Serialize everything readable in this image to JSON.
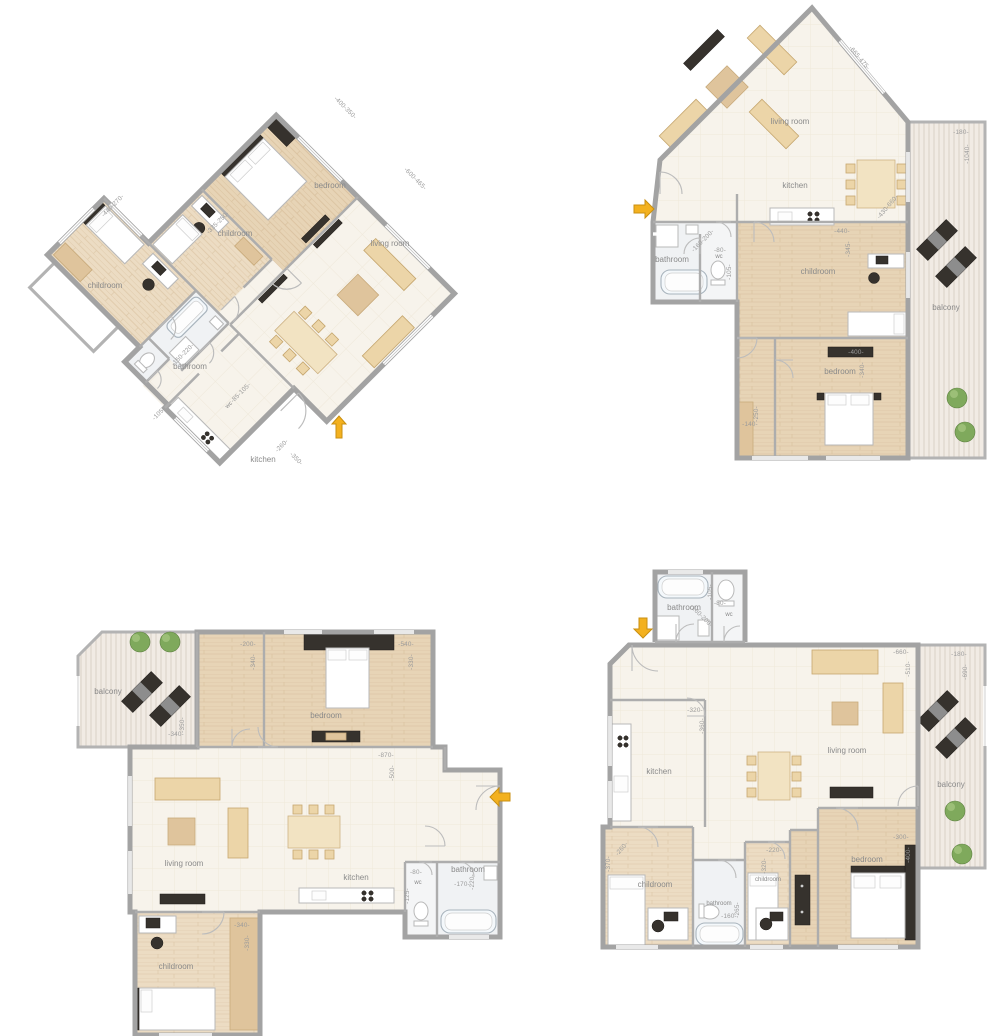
{
  "page": {
    "title": "apartment floor plans",
    "background": "#ffffff"
  },
  "colors": {
    "wall": "#a6a6a6",
    "floor_tile": "#f7f3eb",
    "floor_wood": "#e7d4b6",
    "floor_wood_light": "#ecdcc3",
    "balcony_deck": "#f1ebe4",
    "entry_arrow": "#f3b11f",
    "furniture_tan": "#ecd5a8",
    "furniture_dark": "#36322d",
    "label_text": "#8a8a8a",
    "dim_text": "#9b9b9b"
  },
  "plans": [
    {
      "id": "plan-top-left",
      "orientation": "rotated 45deg",
      "entry_arrow": "up",
      "rooms": {
        "childroom_left": {
          "label": "childroom",
          "dims": "-440-270-"
        },
        "childroom_mid": {
          "label": "childroom",
          "dims": "-335-250-"
        },
        "bedroom": {
          "label": "bedroom",
          "dims": "-400-350-"
        },
        "living_room": {
          "label": "living room",
          "dims": "-600-465-"
        },
        "bathroom": {
          "label": "bathroom",
          "dims": "-150-220-"
        },
        "wc": {
          "label": "wc",
          "dims": "-85-105-"
        },
        "kitchen": {
          "label": "kitchen",
          "dim_w": "-260-",
          "dim_h": "-350-"
        },
        "hall": {
          "dims": "-105-"
        }
      }
    },
    {
      "id": "plan-top-right",
      "orientation": "axis-aligned",
      "entry_arrow": "right",
      "rooms": {
        "living_room": {
          "label": "living room",
          "dims": "-665-475-"
        },
        "kitchen": {
          "label": "kitchen",
          "dims": "-430-660-"
        },
        "bathroom": {
          "label": "bathroom",
          "dims": "-160-200-"
        },
        "wc": {
          "label": "wc",
          "dim_w": "-80-",
          "dim_h": "-105-"
        },
        "childroom": {
          "label": "childroom",
          "dim_w": "-440-",
          "dim_h": "-345-"
        },
        "bedroom": {
          "label": "bedroom",
          "dim_w": "-400-",
          "dim_h": "-340-"
        },
        "closet": {
          "dim_w": "-140-",
          "dim_h": "-250-"
        },
        "balcony": {
          "label": "balcony",
          "dim_w": "-180-",
          "dim_h": "-1040-"
        }
      }
    },
    {
      "id": "plan-bottom-left",
      "orientation": "axis-aligned",
      "entry_arrow": "left",
      "rooms": {
        "balcony": {
          "label": "balcony",
          "dim_w": "-340-",
          "dim_h": "-350-"
        },
        "dressing": {
          "dim_w": "-200-",
          "dim_h": "-340-"
        },
        "bedroom": {
          "label": "bedroom",
          "dim_w": "-540-",
          "dim_h": "-330-"
        },
        "living_room": {
          "label": "living room"
        },
        "hall": {
          "dim_w": "-870-",
          "dim_h": "-500-"
        },
        "kitchen": {
          "label": "kitchen"
        },
        "wc": {
          "label": "wc",
          "dim_w": "-80-",
          "dim_h": "-125-"
        },
        "bathroom": {
          "label": "bathroom",
          "dim_w": "-170-",
          "dim_h": "-220-"
        },
        "childroom": {
          "label": "childroom",
          "dim_w": "-340-",
          "dim_h": "-330-"
        }
      }
    },
    {
      "id": "plan-bottom-right",
      "orientation": "axis-aligned",
      "entry_arrow": "down",
      "rooms": {
        "bathroom_top": {
          "label": "bathroom",
          "dims": "-160-200-"
        },
        "wc": {
          "label": "wc",
          "dim_w": "-80-",
          "dim_h": "-105-"
        },
        "kitchen": {
          "label": "kitchen",
          "dim_w": "-320-",
          "dim_h": "-360-"
        },
        "living_room": {
          "label": "living room",
          "dim_w": "-660-",
          "dim_h": "-510-"
        },
        "balcony": {
          "label": "balcony",
          "dim_w": "-180-",
          "dim_h": "-690-"
        },
        "childroom_left": {
          "label": "childroom",
          "dim_w": "-260-",
          "dim_h": "-370-"
        },
        "bathroom_mid": {
          "label": "bathroom",
          "dim_w": "-160-",
          "dim_h": "-265-"
        },
        "childroom_mid": {
          "label": "childroom",
          "dim_w": "-220-",
          "dim_h": "-320-"
        },
        "bedroom": {
          "label": "bedroom",
          "dim_w": "-300-",
          "dim_h": "-400-"
        }
      }
    }
  ]
}
